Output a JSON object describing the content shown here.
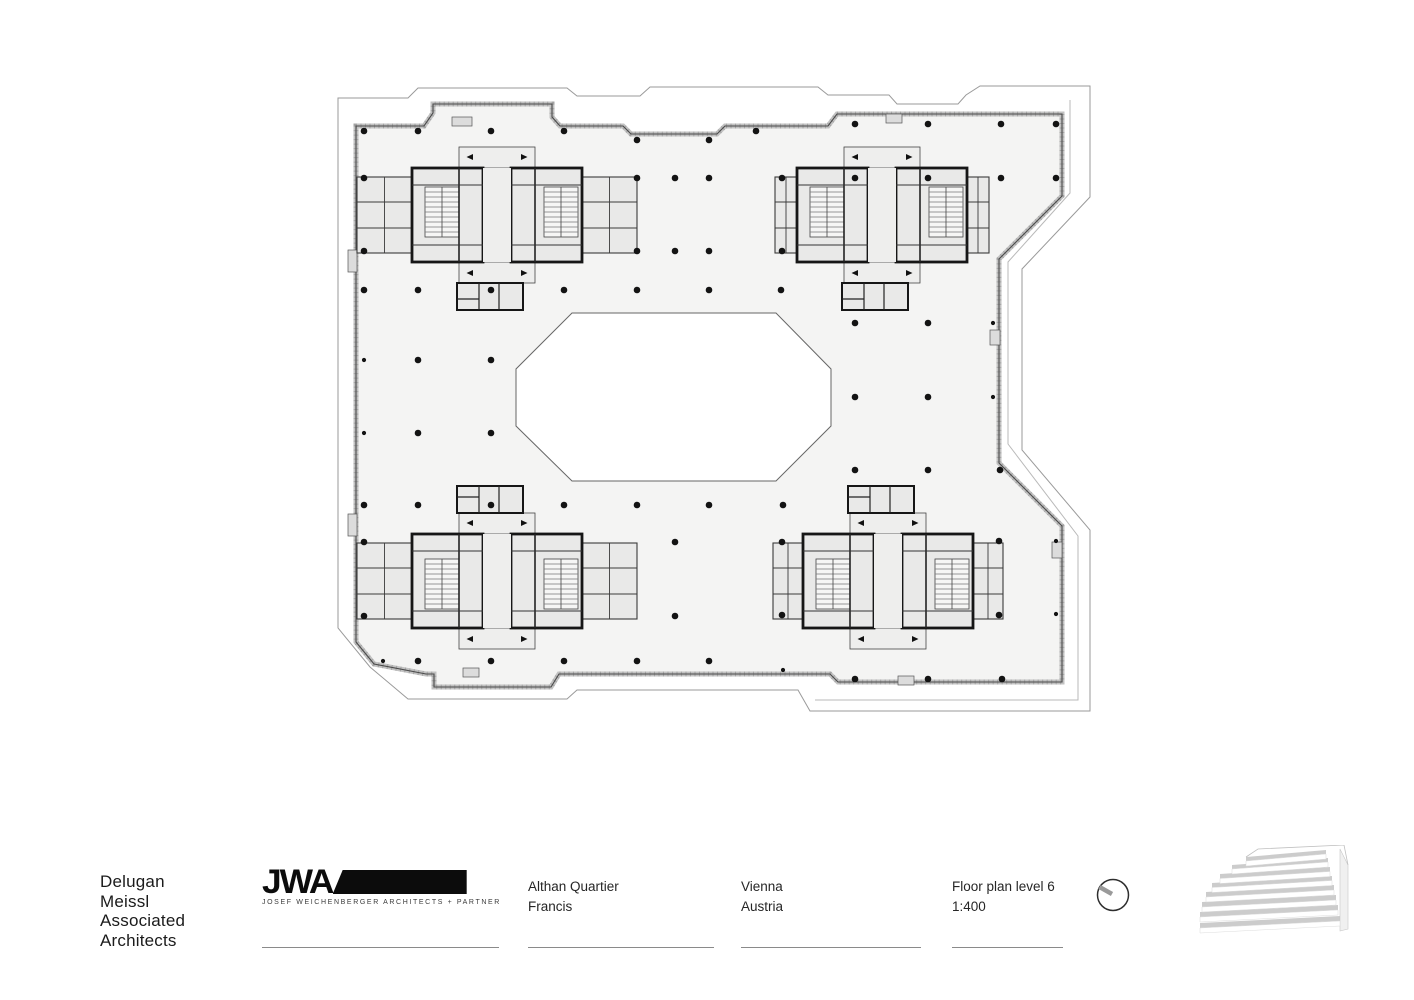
{
  "footer": {
    "firm": {
      "line1": "Delugan",
      "line2": "Meissl",
      "line3": "Associated",
      "line4": "Architects"
    },
    "logo": {
      "letters": "JWA",
      "subtext": "JOSEF WEICHENBERGER ARCHITECTS + PARTNER"
    },
    "project": {
      "line1": "Althan Quartier",
      "line2": "Francis"
    },
    "location": {
      "line1": "Vienna",
      "line2": "Austria"
    },
    "sheet": {
      "line1": "Floor plan level 6",
      "line2": "1:400"
    }
  },
  "plan": {
    "colors": {
      "floor": "#f4f4f3",
      "room": "#e9e9e8",
      "corridor": "#eeeeed",
      "stair": "#f6f6f5",
      "wall": "#161616",
      "wall_thin": "#3a3a3a",
      "edge": "#4a4a4a",
      "band": "#c2c2c2",
      "hatch": "#8a8a8a",
      "outline": "#9a9a9a",
      "outline_light": "#b9b9b9",
      "dot": "#131313",
      "tab": "#dcdcdc"
    },
    "outer_outline": [
      [
        338,
        98
      ],
      [
        408,
        98
      ],
      [
        418,
        88
      ],
      [
        567,
        88
      ],
      [
        577,
        96
      ],
      [
        640,
        96
      ],
      [
        650,
        87
      ],
      [
        818,
        87
      ],
      [
        828,
        95
      ],
      [
        889,
        95
      ],
      [
        897,
        104
      ],
      [
        958,
        104
      ],
      [
        966,
        95
      ],
      [
        980,
        86
      ],
      [
        1090,
        86
      ],
      [
        1090,
        197
      ],
      [
        1022,
        269
      ],
      [
        1022,
        450
      ],
      [
        1090,
        530
      ],
      [
        1090,
        711
      ],
      [
        810,
        711
      ],
      [
        798,
        690
      ],
      [
        577,
        690
      ],
      [
        567,
        699
      ],
      [
        408,
        699
      ],
      [
        370,
        667
      ],
      [
        338,
        628
      ]
    ],
    "terrace_inner": [
      [
        1070,
        100
      ],
      [
        1070,
        193
      ],
      [
        1008,
        262
      ],
      [
        1008,
        444
      ],
      [
        1078,
        536
      ],
      [
        1078,
        700
      ],
      [
        815,
        700
      ]
    ],
    "facade": [
      [
        356,
        126
      ],
      [
        424,
        126
      ],
      [
        433,
        113
      ],
      [
        433,
        104
      ],
      [
        552,
        104
      ],
      [
        552,
        117
      ],
      [
        560,
        126
      ],
      [
        623,
        126
      ],
      [
        631,
        134
      ],
      [
        717,
        134
      ],
      [
        725,
        126
      ],
      [
        828,
        126
      ],
      [
        837,
        114
      ],
      [
        1062,
        114
      ],
      [
        1062,
        196
      ],
      [
        999,
        259
      ],
      [
        999,
        463
      ],
      [
        1062,
        526
      ],
      [
        1062,
        682
      ],
      [
        838,
        682
      ],
      [
        830,
        674
      ],
      [
        559,
        674
      ],
      [
        551,
        687
      ],
      [
        434,
        687
      ],
      [
        434,
        674
      ],
      [
        426,
        674
      ],
      [
        374,
        664
      ],
      [
        356,
        642
      ]
    ],
    "atrium": [
      [
        572,
        313
      ],
      [
        776,
        313
      ],
      [
        831,
        369
      ],
      [
        831,
        426
      ],
      [
        776,
        481
      ],
      [
        572,
        481
      ],
      [
        516,
        426
      ],
      [
        516,
        369
      ]
    ],
    "cores": [
      {
        "cx": 497,
        "cy": 215,
        "flip": 1,
        "halfW": 140
      },
      {
        "cx": 882,
        "cy": 215,
        "flip": 1,
        "halfW": 107
      },
      {
        "cx": 497,
        "cy": 581,
        "flip": -1,
        "halfW": 140
      },
      {
        "cx": 888,
        "cy": 581,
        "flip": -1,
        "halfW": 115
      }
    ],
    "facade_tabs": [
      [
        452,
        117,
        20,
        9
      ],
      [
        886,
        114,
        16,
        9
      ],
      [
        463,
        668,
        16,
        9
      ],
      [
        898,
        676,
        16,
        9
      ],
      [
        348,
        250,
        9,
        22
      ],
      [
        348,
        514,
        9,
        22
      ],
      [
        990,
        330,
        10,
        15
      ],
      [
        1052,
        542,
        10,
        16
      ]
    ],
    "columns_large": [
      [
        364,
        131
      ],
      [
        418,
        131
      ],
      [
        491,
        131
      ],
      [
        564,
        131
      ],
      [
        637,
        140
      ],
      [
        709,
        140
      ],
      [
        756,
        131
      ],
      [
        855,
        124
      ],
      [
        928,
        124
      ],
      [
        1001,
        124
      ],
      [
        1056,
        124
      ],
      [
        364,
        178
      ],
      [
        637,
        178
      ],
      [
        675,
        178
      ],
      [
        709,
        178
      ],
      [
        782,
        178
      ],
      [
        855,
        178
      ],
      [
        928,
        178
      ],
      [
        1001,
        178
      ],
      [
        1056,
        178
      ],
      [
        364,
        251
      ],
      [
        637,
        251
      ],
      [
        675,
        251
      ],
      [
        709,
        251
      ],
      [
        782,
        251
      ],
      [
        364,
        290
      ],
      [
        418,
        290
      ],
      [
        491,
        290
      ],
      [
        564,
        290
      ],
      [
        637,
        290
      ],
      [
        709,
        290
      ],
      [
        781,
        290
      ],
      [
        418,
        360
      ],
      [
        491,
        360
      ],
      [
        855,
        323
      ],
      [
        928,
        323
      ],
      [
        418,
        433
      ],
      [
        491,
        433
      ],
      [
        855,
        397
      ],
      [
        928,
        397
      ],
      [
        855,
        470
      ],
      [
        928,
        470
      ],
      [
        1000,
        470
      ],
      [
        364,
        505
      ],
      [
        418,
        505
      ],
      [
        491,
        505
      ],
      [
        564,
        505
      ],
      [
        637,
        505
      ],
      [
        709,
        505
      ],
      [
        783,
        505
      ],
      [
        364,
        542
      ],
      [
        675,
        542
      ],
      [
        782,
        542
      ],
      [
        999,
        541
      ],
      [
        364,
        616
      ],
      [
        675,
        616
      ],
      [
        782,
        615
      ],
      [
        999,
        615
      ],
      [
        418,
        661
      ],
      [
        491,
        661
      ],
      [
        564,
        661
      ],
      [
        637,
        661
      ],
      [
        709,
        661
      ],
      [
        855,
        679
      ],
      [
        928,
        679
      ],
      [
        1002,
        679
      ]
    ],
    "columns_small": [
      [
        364,
        360
      ],
      [
        364,
        433
      ],
      [
        993,
        323
      ],
      [
        993,
        397
      ],
      [
        1056,
        541
      ],
      [
        1056,
        614
      ],
      [
        383,
        661
      ],
      [
        783,
        670
      ]
    ]
  },
  "building_icon": {
    "tilt": 7,
    "bands": [
      [
        2,
        78,
        140,
        5
      ],
      [
        2,
        67,
        138,
        5
      ],
      [
        4,
        57,
        134,
        5
      ],
      [
        8,
        47,
        128,
        5
      ],
      [
        14,
        38,
        120,
        4.5
      ],
      [
        22,
        29,
        110,
        4.5
      ],
      [
        34,
        20,
        96,
        4
      ],
      [
        48,
        12,
        80,
        4
      ]
    ],
    "face": [
      [
        142,
        4
      ],
      [
        150,
        20
      ],
      [
        150,
        84
      ],
      [
        142,
        86
      ]
    ],
    "roof": [
      [
        48,
        12
      ],
      [
        60,
        4
      ],
      [
        146,
        0
      ],
      [
        150,
        20
      ]
    ]
  },
  "north_icon": {
    "circle": {
      "cx": 17,
      "cy": 17,
      "r": 15.5
    },
    "needle": [
      [
        3.5,
        9
      ],
      [
        16,
        16
      ]
    ]
  }
}
